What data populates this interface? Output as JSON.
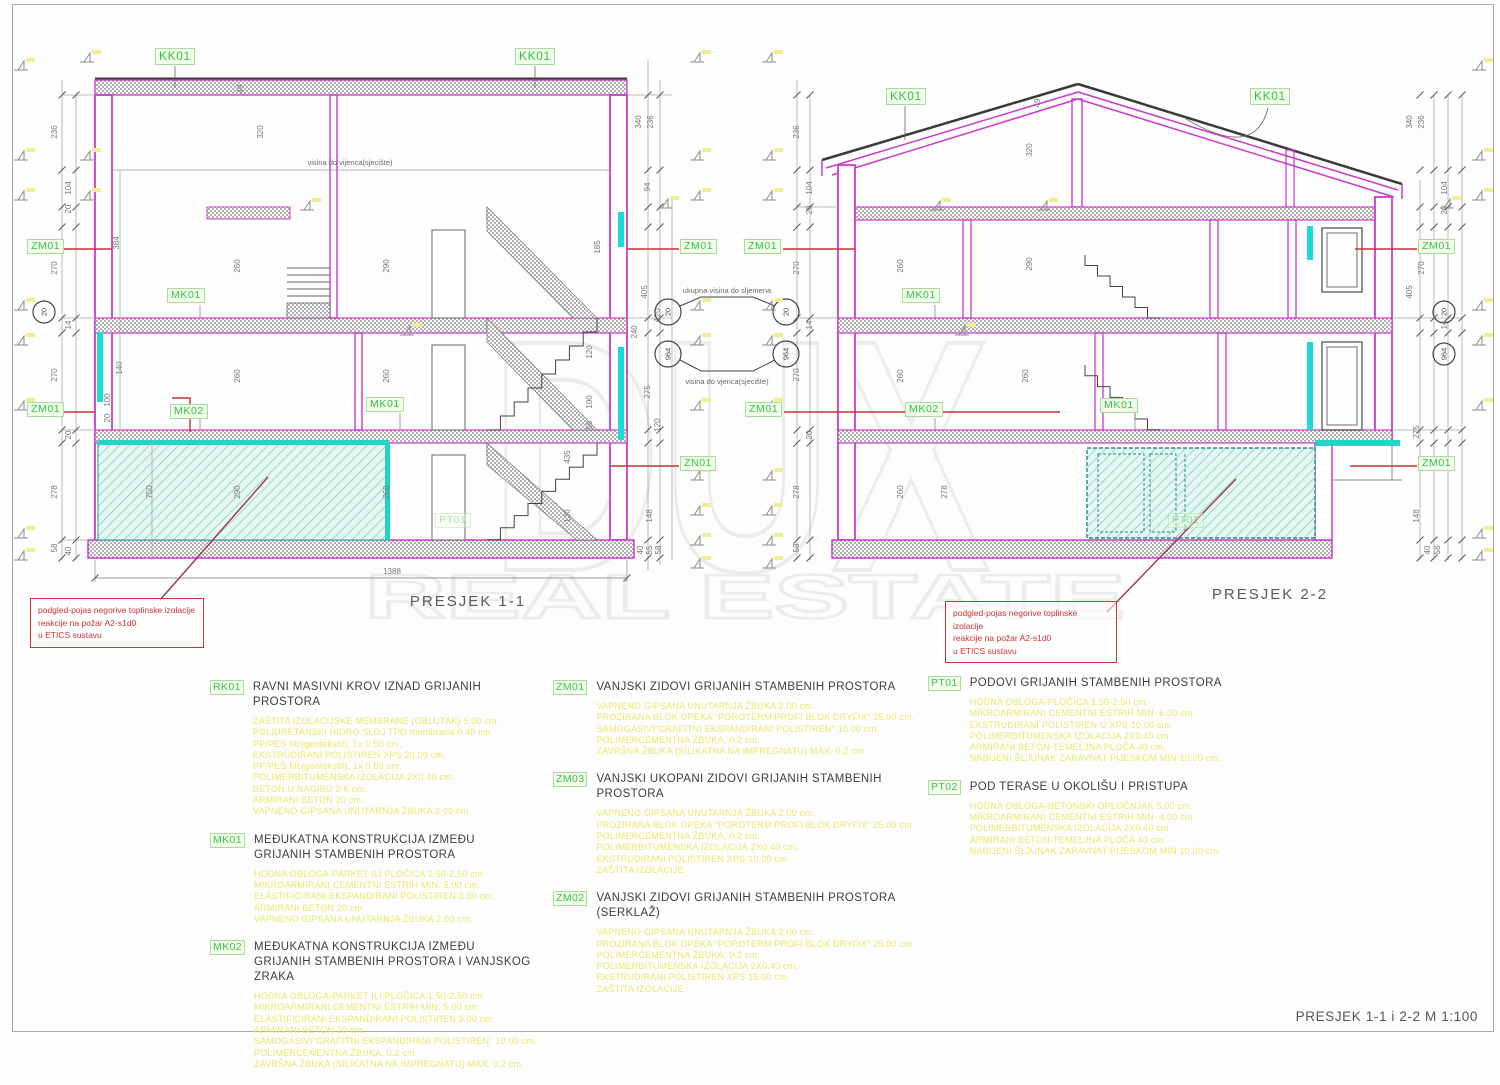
{
  "sheet": {
    "title": "PRESJEK 1-1 i 2-2  M 1:100"
  },
  "watermark": {
    "line1": "DUX",
    "line2": "REAL ESTATE"
  },
  "sections": [
    {
      "title": "PRESJEK 1-1"
    },
    {
      "title": "PRESJEK 2-2"
    }
  ],
  "texts": {
    "eave_line_label": "visina do vijenca(sjecište)",
    "ridge_note": "ukupna visina do sljemena",
    "eave_note": "visina do vjenca(sjecište)"
  },
  "levels": {
    "upper": "20",
    "lower": "964"
  },
  "note_box": {
    "lines": [
      "podgled-pojas negorive toplinske izolacije",
      "reakcije na požar A2-s1d0",
      "u ETICS sustavu"
    ]
  },
  "drawing_labels": [
    {
      "t": "KK01",
      "x": 155,
      "y": 48,
      "big": 1
    },
    {
      "t": "KK01",
      "x": 515,
      "y": 48,
      "big": 1
    },
    {
      "t": "ZM01",
      "x": 27,
      "y": 239
    },
    {
      "t": "MK01",
      "x": 167,
      "y": 288
    },
    {
      "t": "ZM01",
      "x": 27,
      "y": 402
    },
    {
      "t": "MK02",
      "x": 170,
      "y": 404
    },
    {
      "t": "MK01",
      "x": 366,
      "y": 397
    },
    {
      "t": "PT01",
      "x": 435,
      "y": 513,
      "f": 1
    },
    {
      "t": "ZM01",
      "x": 680,
      "y": 239
    },
    {
      "t": "ZN01",
      "x": 680,
      "y": 456
    },
    {
      "t": "KK01",
      "x": 886,
      "y": 88,
      "big": 1
    },
    {
      "t": "KK01",
      "x": 1250,
      "y": 88,
      "big": 1
    },
    {
      "t": "ZM01",
      "x": 744,
      "y": 239
    },
    {
      "t": "MK01",
      "x": 902,
      "y": 288
    },
    {
      "t": "ZM01",
      "x": 745,
      "y": 402
    },
    {
      "t": "MK02",
      "x": 905,
      "y": 402
    },
    {
      "t": "MK01",
      "x": 1100,
      "y": 398
    },
    {
      "t": "PT01",
      "x": 1168,
      "y": 513,
      "f": 1
    },
    {
      "t": "ZM01",
      "x": 1418,
      "y": 239
    },
    {
      "t": "ZM01",
      "x": 1418,
      "y": 456
    }
  ],
  "dim_texts": [
    {
      "t": "236",
      "x": 57,
      "y": 132,
      "r": 1
    },
    {
      "t": "270",
      "x": 57,
      "y": 268,
      "r": 1
    },
    {
      "t": "270",
      "x": 57,
      "y": 375,
      "r": 1
    },
    {
      "t": "278",
      "x": 57,
      "y": 492,
      "r": 1
    },
    {
      "t": "58",
      "x": 57,
      "y": 548,
      "r": 1
    },
    {
      "t": "104",
      "x": 71,
      "y": 188,
      "r": 1
    },
    {
      "t": "20",
      "x": 71,
      "y": 209,
      "r": 1
    },
    {
      "t": "14",
      "x": 71,
      "y": 325,
      "r": 1
    },
    {
      "t": "20",
      "x": 71,
      "y": 435,
      "r": 1
    },
    {
      "t": "40",
      "x": 71,
      "y": 551,
      "r": 1
    },
    {
      "t": "384",
      "x": 119,
      "y": 243,
      "r": 1
    },
    {
      "t": "140",
      "x": 122,
      "y": 368,
      "r": 1
    },
    {
      "t": "100",
      "x": 110,
      "y": 400,
      "r": 1
    },
    {
      "t": "20",
      "x": 110,
      "y": 418,
      "r": 1
    },
    {
      "t": "750",
      "x": 152,
      "y": 492,
      "r": 1
    },
    {
      "t": "49",
      "x": 243,
      "y": 89,
      "r": 1
    },
    {
      "t": "320",
      "x": 263,
      "y": 132,
      "r": 1
    },
    {
      "t": "260",
      "x": 240,
      "y": 266,
      "r": 1
    },
    {
      "t": "290",
      "x": 389,
      "y": 266,
      "r": 1
    },
    {
      "t": "260",
      "x": 240,
      "y": 376,
      "r": 1
    },
    {
      "t": "260",
      "x": 389,
      "y": 376,
      "r": 1
    },
    {
      "t": "290",
      "x": 240,
      "y": 492,
      "r": 1
    },
    {
      "t": "260",
      "x": 389,
      "y": 492,
      "r": 1
    },
    {
      "t": "435",
      "x": 570,
      "y": 457,
      "r": 1
    },
    {
      "t": "130",
      "x": 570,
      "y": 516,
      "r": 1
    },
    {
      "t": "185",
      "x": 600,
      "y": 247,
      "r": 1
    },
    {
      "t": "120",
      "x": 592,
      "y": 352,
      "r": 1
    },
    {
      "t": "100",
      "x": 592,
      "y": 402,
      "r": 1
    },
    {
      "t": "55",
      "x": 592,
      "y": 425,
      "r": 1
    },
    {
      "t": "148",
      "x": 652,
      "y": 516,
      "r": 1
    },
    {
      "t": "275",
      "x": 650,
      "y": 392,
      "r": 1
    },
    {
      "t": "120",
      "x": 660,
      "y": 315,
      "r": 1
    },
    {
      "t": "120",
      "x": 660,
      "y": 425,
      "r": 1
    },
    {
      "t": "94",
      "x": 650,
      "y": 187,
      "r": 1
    },
    {
      "t": "405",
      "x": 647,
      "y": 292,
      "r": 1
    },
    {
      "t": "340",
      "x": 641,
      "y": 122,
      "r": 1
    },
    {
      "t": "236",
      "x": 653,
      "y": 122,
      "r": 1
    },
    {
      "t": "240",
      "x": 637,
      "y": 332,
      "r": 1
    },
    {
      "t": "40",
      "x": 643,
      "y": 550,
      "r": 1
    },
    {
      "t": "55",
      "x": 652,
      "y": 550,
      "r": 1
    },
    {
      "t": "58",
      "x": 661,
      "y": 550,
      "r": 1
    },
    {
      "t": "236",
      "x": 799,
      "y": 132,
      "r": 1
    },
    {
      "t": "104",
      "x": 812,
      "y": 188,
      "r": 1
    },
    {
      "t": "270",
      "x": 799,
      "y": 268,
      "r": 1
    },
    {
      "t": "270",
      "x": 799,
      "y": 375,
      "r": 1
    },
    {
      "t": "278",
      "x": 799,
      "y": 492,
      "r": 1
    },
    {
      "t": "58",
      "x": 799,
      "y": 548,
      "r": 1
    },
    {
      "t": "20",
      "x": 812,
      "y": 210,
      "r": 1
    },
    {
      "t": "14",
      "x": 812,
      "y": 325,
      "r": 1
    },
    {
      "t": "20",
      "x": 812,
      "y": 435,
      "r": 1
    },
    {
      "t": "320",
      "x": 1032,
      "y": 150,
      "r": 1
    },
    {
      "t": "290",
      "x": 1032,
      "y": 264,
      "r": 1
    },
    {
      "t": "260",
      "x": 903,
      "y": 266,
      "r": 1
    },
    {
      "t": "260",
      "x": 903,
      "y": 376,
      "r": 1
    },
    {
      "t": "260",
      "x": 1028,
      "y": 376,
      "r": 1
    },
    {
      "t": "260",
      "x": 903,
      "y": 492,
      "r": 1
    },
    {
      "t": "278",
      "x": 947,
      "y": 492,
      "r": 1
    },
    {
      "t": "49",
      "x": 1040,
      "y": 103,
      "r": 1
    },
    {
      "t": "340",
      "x": 1412,
      "y": 122,
      "r": 1
    },
    {
      "t": "236",
      "x": 1424,
      "y": 122,
      "r": 1
    },
    {
      "t": "104",
      "x": 1447,
      "y": 188,
      "r": 1
    },
    {
      "t": "270",
      "x": 1424,
      "y": 268,
      "r": 1
    },
    {
      "t": "405",
      "x": 1412,
      "y": 292,
      "r": 1
    },
    {
      "t": "14",
      "x": 1447,
      "y": 325,
      "r": 1
    },
    {
      "t": "275",
      "x": 1419,
      "y": 432,
      "r": 1
    },
    {
      "t": "148",
      "x": 1419,
      "y": 516,
      "r": 1
    },
    {
      "t": "40",
      "x": 1430,
      "y": 550,
      "r": 1
    },
    {
      "t": "58",
      "x": 1440,
      "y": 550,
      "r": 1
    },
    {
      "t": "20",
      "x": 1447,
      "y": 210,
      "r": 1
    },
    {
      "t": "1388",
      "x": 392,
      "y": 574,
      "r": 0
    }
  ],
  "legend": {
    "columns": [
      [
        {
          "code": "RK01",
          "title": "RAVNI MASIVNI KROV IZNAD GRIJANIH PROSTORA",
          "layers": [
            "ZAŠTITA IZOLACIJSKE MEMBRANE (OBLUTAK) 5.00 cm.",
            "POLIURETANSKI HIDRO SLOJ TPO membrana 0.40 cm.",
            "PP/PES filc(geotekstil), 1x 0.50 cm.",
            "EKSTRUDIRANI POLISTIREN XPS 20.00 cm.",
            "PP/PES filc(geotekstil), 1x 0.50 cm.",
            "POLIMERBITUMENSKA IZOLACIJA 2X0.40 cm.",
            "BETON U NAGIBU 2-6 cm.",
            "ARMIRANI BETON 20 cm.",
            "VAPNENO GIPSANA UNUTARNJA ŽBUKA 2.00 cm."
          ]
        },
        {
          "code": "MK01",
          "title": "MEĐUKATNA KONSTRUKCIJA IZMEĐU\nGRIJANIH STAMBENIH PROSTORA",
          "layers": [
            "HODNA OBLOGA-PARKET ILI PLOČICA 1.50-2.50 cm.",
            "MIKROARMIRANI CEMENTNI ESTRIH MIN. 5.00 cm.",
            "ELASTIFICIRANI EKSPANDIRANI POLISTIREN 3.00 cm.",
            "ARMIRANI BETON 20 cm.",
            "VAPNENO GIPSANA UNUTARNJA ŽBUKA 2.00 cm."
          ]
        },
        {
          "code": "MK02",
          "title": "MEĐUKATNA KONSTRUKCIJA IZMEĐU\nGRIJANIH STAMBENIH PROSTORA I VANJSKOG ZRAKA",
          "layers": [
            "HODNA OBLOGA-PARKET ILI PLOČICA 1.50-2.50 cm.",
            "MIKROARMIRANI CEMENTNI ESTRIH MIN. 5.00 cm.",
            "ELASTIFICIRANI EKSPANDIRANI POLISTIREN 3.00 cm.",
            "ARMIRANI BETON 20 cm.",
            "SAMOGASIVI\"GRAFITNI EKSPANDIRANI POLISTIREN\" 10.00 cm.",
            "POLIMERCEMENTNA ŽBUKA, 0.2 cm.",
            "ZAVRŠNA ŽBUKA (SILIKATNA NA IMPREGNATU) MAX. 0.2 cm."
          ]
        }
      ],
      [
        {
          "code": "ZM01",
          "title": "VANJSKI ZIDOVI GRIJANIH STAMBENIH PROSTORA",
          "layers": [
            "VAPNENO GIPSANA UNUTARNJA ŽBUKA 2.00 cm.",
            "PROZIRANA BLOK OPEKA \"POROTERM PROFI BLOK DRYFIX\" 25.00 cm.",
            "SAMOGASIVI\"GRAFITNI EKSPANDIRANI POLISTIREN\" 10.00 cm.",
            "POLIMERCEMENTNA ŽBUKA, 0.2 cm.",
            "ZAVRŠNA ŽBUKA (SILIKATNA NA IMPREGNATU) MAX. 0.2 cm."
          ]
        },
        {
          "code": "ZM03",
          "title": "VANJSKI UKOPANI ZIDOVI GRIJANIH STAMBENIH PROSTORA",
          "layers": [
            "VAPNENO GIPSANA UNUTARNJA ŽBUKA 2.00 cm.",
            "PROZIRANA BLOK OPEKA \"POROTERM PROFI BLOK DRYFIX\" 25.00 cm.",
            "POLIMERCEMENTNA ŽBUKA, 0.2 cm.",
            "POLIMERBITUMENSKA IZOLACIJA 2X0.40 cm.",
            "EKSTRUDIRANI POLISTIREN XPS 10.00 cm.",
            "ZAŠTITA IZOLACIJE"
          ]
        },
        {
          "code": "ZM02",
          "title": "VANJSKI ZIDOVI GRIJANIH STAMBENIH PROSTORA (SERKLAŽ)",
          "layers": [
            "VAPNENO GIPSANA UNUTARNJA ŽBUKA 2.00 cm.",
            "PROZIRANA BLOK OPEKA \"POROTERM PROFI BLOK DRYFIX\" 25.00 cm.",
            "POLIMERCEMENTNA ŽBUKA, 0.2 cm.",
            "POLIMERBITUMENSKA IZOLACIJA 2X0.40 cm.",
            "EKSTRUDIRANI POLISTIREN XPS 15.00 cm.",
            "ZAŠTITA IZOLACIJE"
          ]
        }
      ],
      [
        {
          "code": "PT01",
          "title": "PODOVI GRIJANIH STAMBENIH PROSTORA",
          "layers": [
            "HODNA OBLOGA-PLOČICA 1.50-2.50 cm.",
            "MIKROARMIRANI CEMENTNI ESTRIH MIN. 6.00 cm.",
            "EKSTRUDIRANI POLISTIREN U XPS 10.00 cm.",
            "POLIMERBITUMENSKA IZOLACIJA 2X0.40 cm.",
            "ARMIRANI BETON-TEMELJNA PLOČA 40 cm.",
            "NABIJENI ŠLJUNAK ZARAVNAT PIJESKOM MIN 10.00 cm."
          ]
        },
        {
          "code": "PT02",
          "title": "POD TERASE U OKOLIŠU I PRISTUPA",
          "layers": [
            "HODNA OBLOGA-BETONSKI OPLOČNJAK 5.00 cm.",
            "MIKROARMIRANI CEMENTNI ESTRIH MIN. 4.00 cm.",
            "POLIMERBITUMENSKA IZOLACIJA 2X0.40 cm.",
            "ARMIRANI BETON-TEMELJNA PLOČA 40 cm.",
            "NABIJENI ŠLJUNAK ZARAVNAT PIJESKOM MIN 10.00 cm."
          ]
        }
      ]
    ]
  }
}
